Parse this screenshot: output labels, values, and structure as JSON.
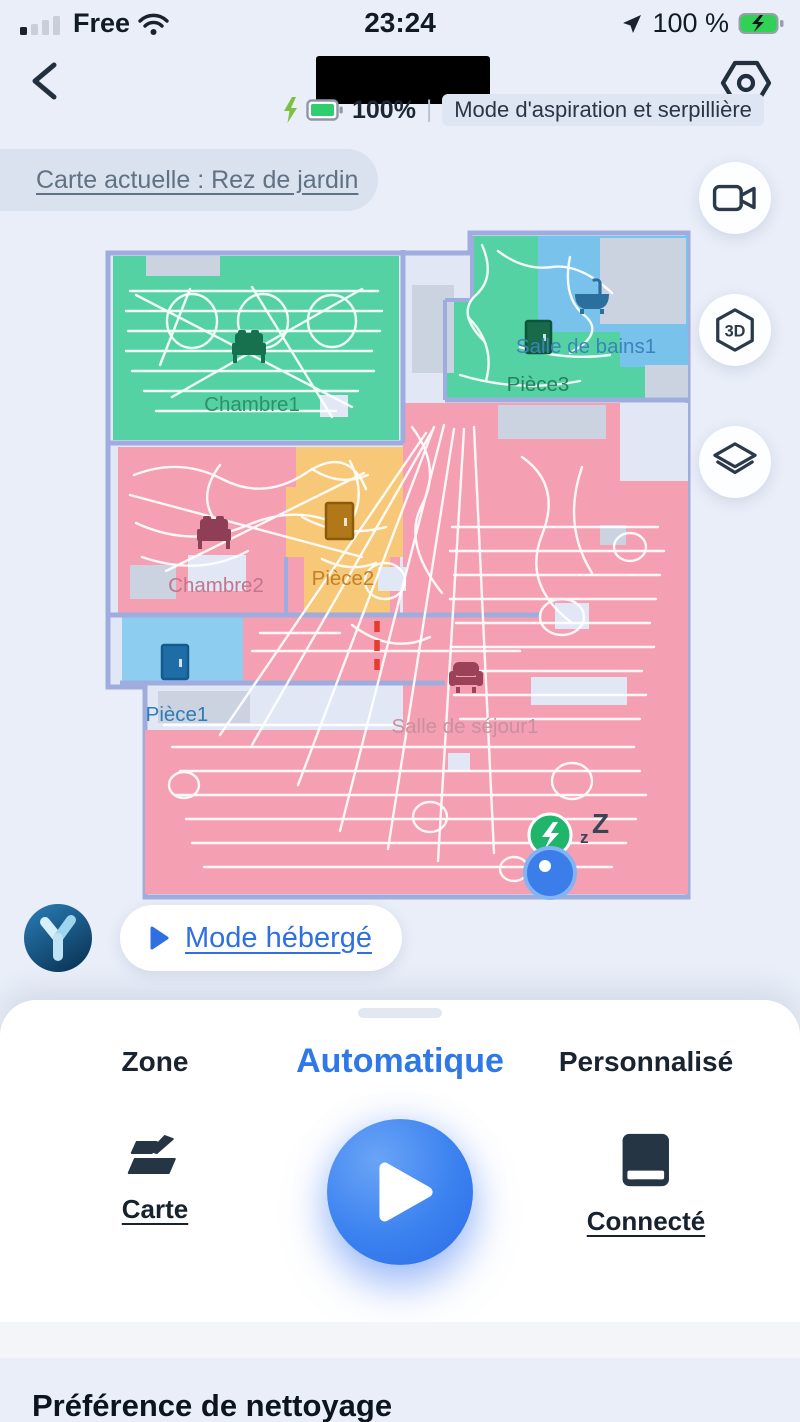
{
  "status_bar": {
    "carrier": "Free",
    "time": "23:24",
    "battery": "100 %"
  },
  "header": {
    "device_battery": "100%",
    "mode_badge": "Mode d'aspiration et serpillière"
  },
  "map_banner": "Carte actuelle : Rez de jardin",
  "map": {
    "rooms": [
      {
        "name": "Chambre1",
        "color": "#54d2a4",
        "label_color": "#2f9068",
        "icon": "bed"
      },
      {
        "name": "Pièce3",
        "color": "#54d2a4",
        "label_color": "#27805a",
        "icon": "door"
      },
      {
        "name": "Salle de bains1",
        "color": "#79c2ec",
        "label_color": "#3b83ba",
        "icon": "bathtub"
      },
      {
        "name": "Chambre2",
        "color": "#f59fb2",
        "label_color": "#c3758e",
        "icon": "bed"
      },
      {
        "name": "Pièce2",
        "color": "#f7c878",
        "label_color": "#c08128",
        "icon": "door"
      },
      {
        "name": "Pièce1",
        "color": "#8ccdf0",
        "label_color": "#2e7cb8",
        "icon": "door"
      },
      {
        "name": "Salle de séjour1",
        "color": "#f59fb2",
        "label_color": "#c9909e",
        "icon": "sofa"
      }
    ],
    "sleep_small": "z",
    "sleep_big": "Z",
    "virtual_wall_color": "#e63b2e",
    "dock_color": "#1fb56b",
    "robot_color": "#3b7de9"
  },
  "floating_buttons": {
    "three_d_label": "3D"
  },
  "hosted_mode_label": "Mode hébergé",
  "tabs": [
    {
      "label": "Zone",
      "active": false
    },
    {
      "label": "Automatique",
      "active": true
    },
    {
      "label": "Personnalisé",
      "active": false
    }
  ],
  "actions": {
    "map": "Carte",
    "dock": "Connecté"
  },
  "section_heading": "Préférence de nettoyage",
  "colors": {
    "accent_blue": "#2f78e8",
    "battery_green": "#2ece6e"
  }
}
